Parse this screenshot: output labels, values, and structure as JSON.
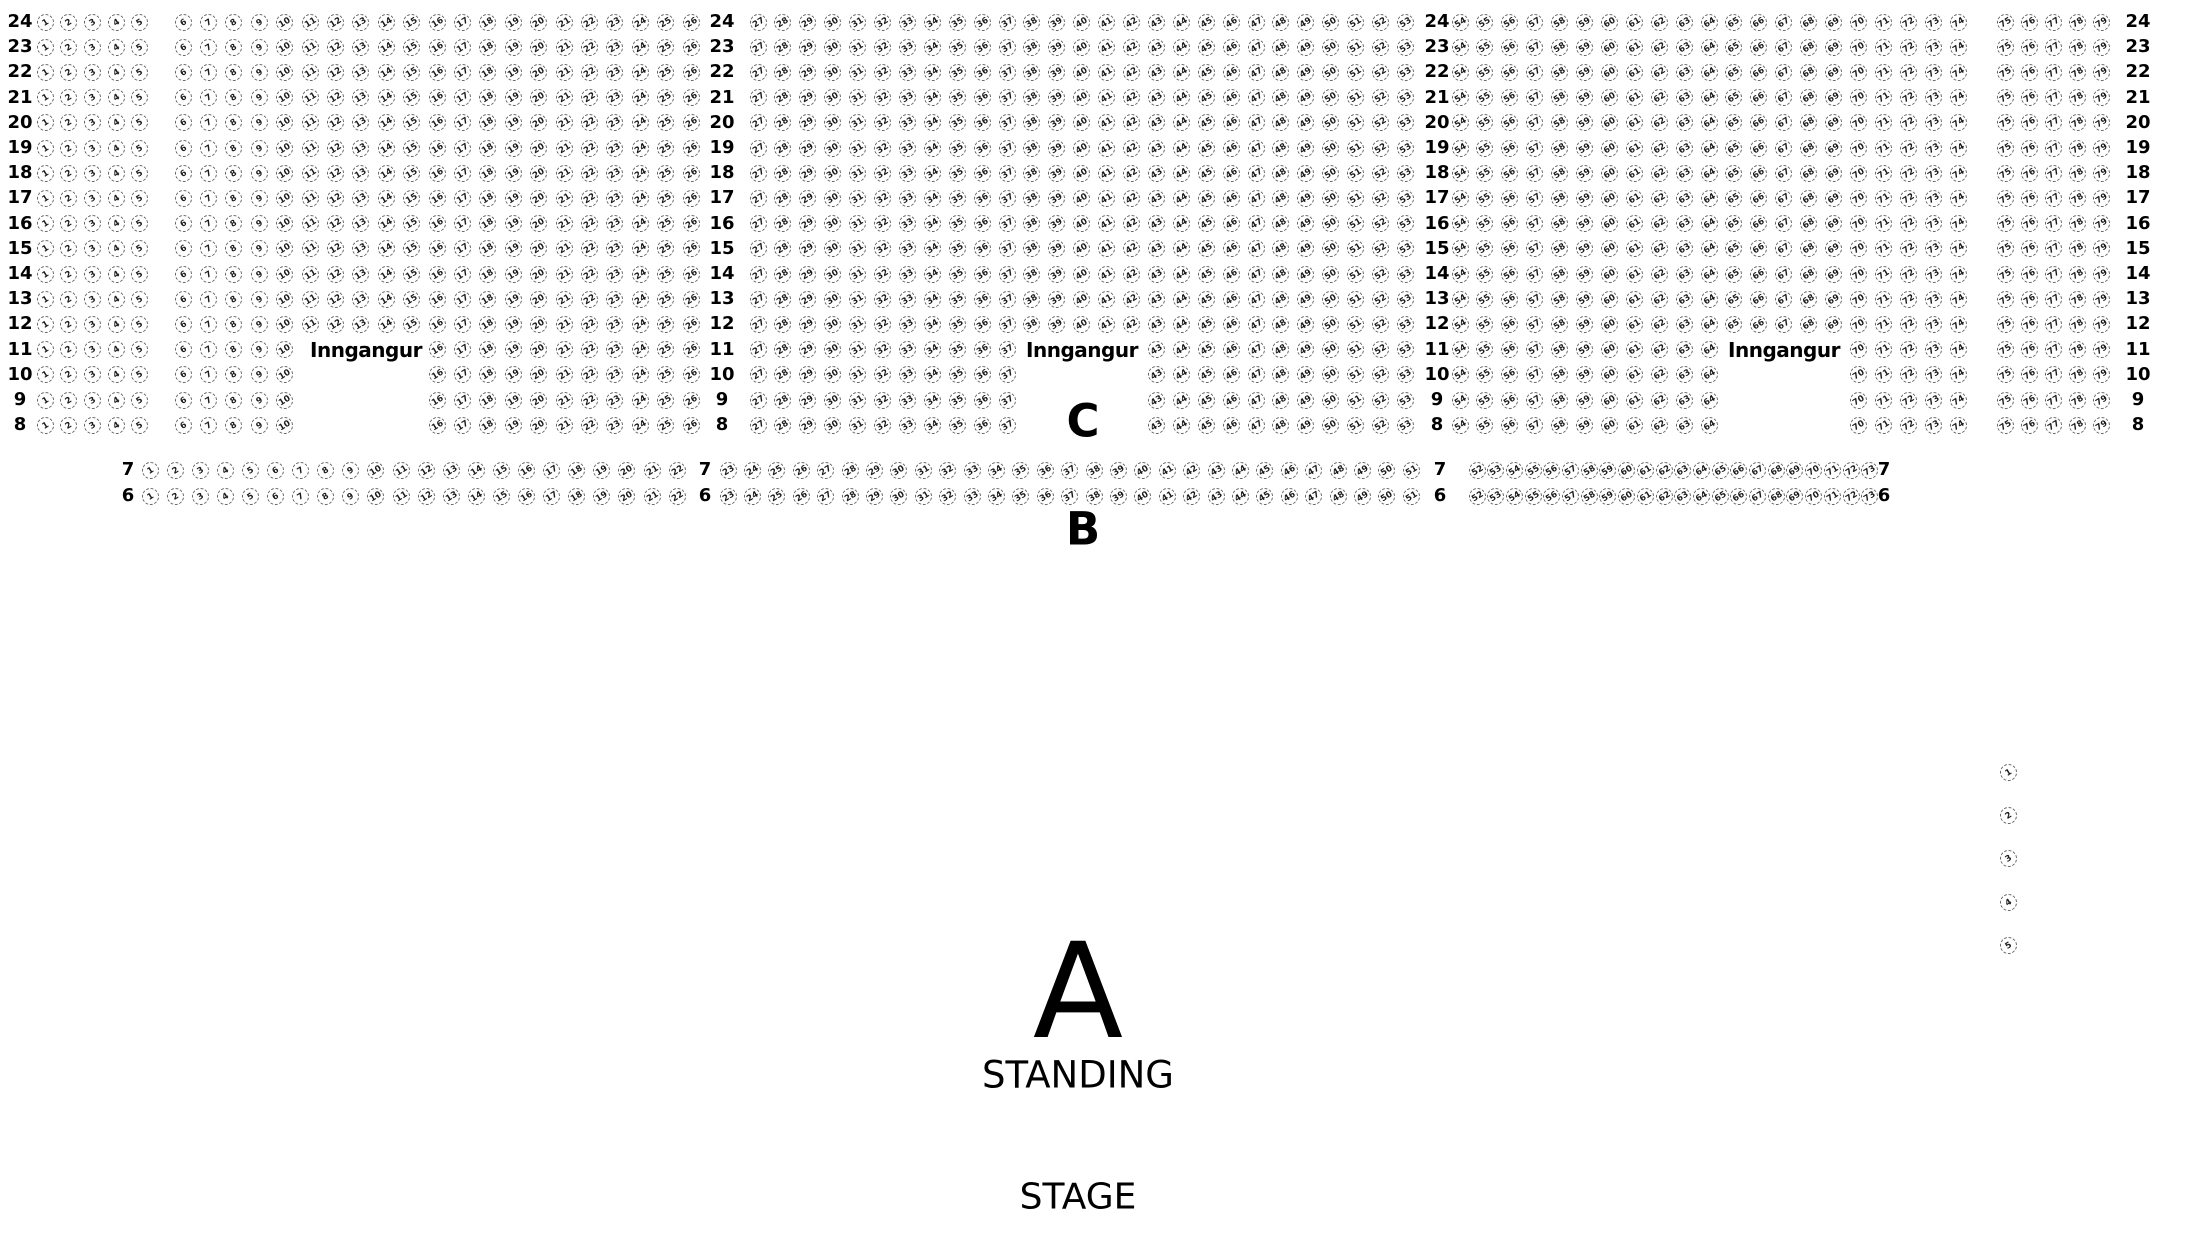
{
  "labels": {
    "entrance": "Inngangur",
    "section_c": "C",
    "section_b": "B",
    "section_a": "A",
    "standing": "STANDING",
    "stage": "STAGE"
  },
  "annotations": {
    "entrances": [
      {
        "x": 366,
        "y": 350
      },
      {
        "x": 1082,
        "y": 350
      },
      {
        "x": 1784,
        "y": 350
      }
    ],
    "section_c": {
      "x": 1083,
      "y": 421
    },
    "section_b": {
      "x": 1083,
      "y": 529
    },
    "section_a": {
      "x": 1078,
      "y": 992
    },
    "standing": {
      "x": 1078,
      "y": 1075
    },
    "stage": {
      "x": 1078,
      "y": 1197
    }
  },
  "seatmap": {
    "colors": {
      "seat_border": "#666666",
      "seat_text": "#1a1a1a",
      "label_text": "#000000"
    },
    "upper": {
      "rows": [
        24,
        23,
        22,
        21,
        20,
        19,
        18,
        17,
        16,
        15,
        14,
        13,
        12,
        11,
        10,
        9,
        8
      ],
      "first_row_center_y": 22,
      "row_step": 25.2,
      "entrance_rows": [
        11,
        10,
        9,
        8
      ],
      "label_column_xs": [
        20,
        722,
        1437,
        2138
      ],
      "blocks": [
        {
          "seat_from": 1,
          "seat_to": 5,
          "x_first": 45,
          "x_step": 23.7
        },
        {
          "seat_from": 6,
          "seat_to": 26,
          "x_first": 183,
          "x_step": 25.4,
          "entrance_gap_from": 11,
          "entrance_gap_to": 15
        },
        {
          "seat_from": 27,
          "seat_to": 53,
          "x_first": 758,
          "x_step": 24.9,
          "entrance_gap_from": 38,
          "entrance_gap_to": 42
        },
        {
          "seat_from": 54,
          "seat_to": 74,
          "x_first": 1460,
          "x_step": 24.9,
          "entrance_gap_from": 65,
          "entrance_gap_to": 69
        },
        {
          "seat_from": 75,
          "seat_to": 79,
          "x_first": 2005,
          "x_step": 24
        }
      ]
    },
    "lower": {
      "rows": [
        7,
        6
      ],
      "row_center_ys": [
        470,
        496
      ],
      "label_xs": [
        128,
        705,
        1440,
        1884
      ],
      "segments": [
        {
          "seat_from": 1,
          "seat_to": 22,
          "x_first": 150,
          "x_step": 25.1
        },
        {
          "seat_from": 23,
          "seat_to": 51,
          "x_first": 728,
          "x_step": 24.4
        },
        {
          "seat_from": 52,
          "seat_to": 73,
          "x_first": 1477,
          "x_step": 18.7
        }
      ]
    },
    "side_column": {
      "seats": [
        1,
        2,
        3,
        4,
        5
      ],
      "x": 2008,
      "y_first": 772,
      "y_step": 43.4
    }
  }
}
